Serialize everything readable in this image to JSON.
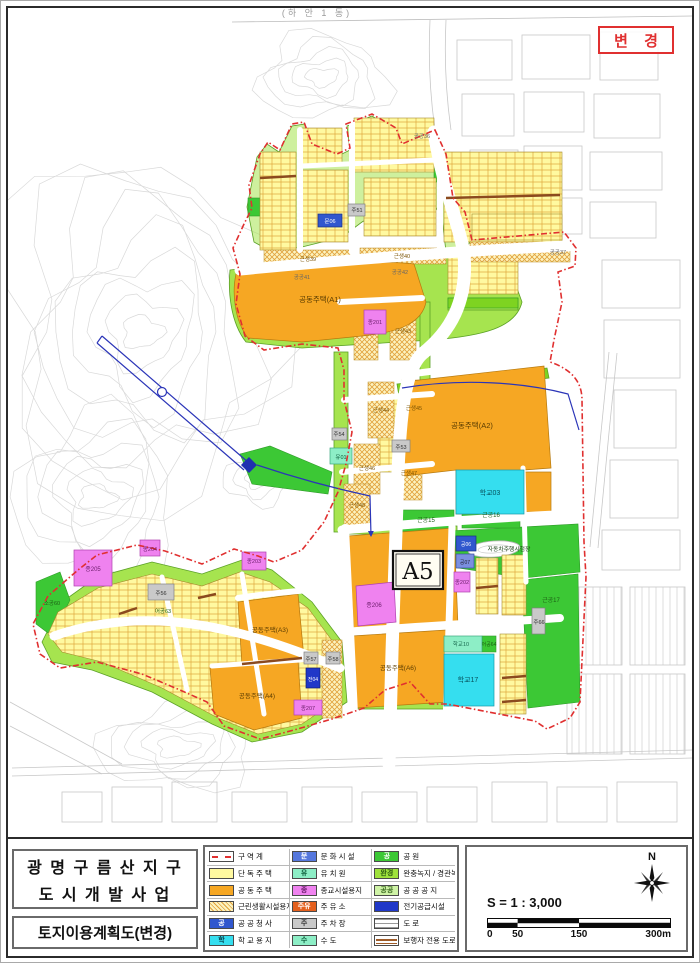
{
  "stamp": {
    "label": "변 경"
  },
  "title_block": {
    "line1": "광 명 구 름 산 지 구",
    "line2": "도 시 개 발 사 업",
    "subtitle": "토지이용계획도(변경)"
  },
  "legend": {
    "columns": [
      [
        {
          "label": "구 역 계",
          "kind": "boundary"
        },
        {
          "label": "단 독 주 택",
          "bg": "#FFF9A0"
        },
        {
          "label": "공 동 주 택",
          "bg": "#F6A723"
        },
        {
          "label": "근린생활시설용지",
          "kind": "hatch"
        },
        {
          "label": "공 공 청 사",
          "bg": "#3057CE",
          "txt": "공"
        },
        {
          "label": "학 교 용 지",
          "bg": "#35DEEF",
          "txt": "학",
          "txtc": "#063a46"
        }
      ],
      [
        {
          "label": "문 화 시 설",
          "bg": "#5577DD",
          "txt": "문"
        },
        {
          "label": "유 치 원",
          "bg": "#8DEEC6",
          "txt": "유",
          "txtc": "#0b5c3a"
        },
        {
          "label": "종교시설용지",
          "bg": "#EF82EF",
          "txt": "종",
          "txtc": "#6b1d6b"
        },
        {
          "label": "주 유 소",
          "bg": "#E4601E",
          "txt": "주유"
        },
        {
          "label": "주 차 장",
          "bg": "#C9C9C9",
          "txt": "주",
          "txtc": "#333333"
        },
        {
          "label": "수 도",
          "bg": "#8DEEC6",
          "txt": "수",
          "txtc": "#0b5c3a"
        }
      ],
      [
        {
          "label": "공 원",
          "bg": "#3CC835",
          "txt": "공"
        },
        {
          "label": "완충녹지 / 경관녹지",
          "bg": "#9FE23C",
          "txt": "완경",
          "txtc": "#2a5a10"
        },
        {
          "label": "공 공 공 지",
          "bg": "#CFF3A6",
          "txt": "공공",
          "txtc": "#3a6a20"
        },
        {
          "label": "전기공급시설",
          "bg": "#2038C8"
        },
        {
          "label": "도 로",
          "kind": "road"
        },
        {
          "label": "보행자 전용 도로",
          "kind": "ped"
        }
      ]
    ]
  },
  "scale": {
    "label": "S = 1 : 3,000",
    "north_label": "N",
    "breaks": [
      0,
      50,
      150,
      300
    ],
    "ticks": [
      "0",
      "50",
      "150",
      "300m"
    ],
    "row_colors": [
      [
        "#ffffff",
        "#0a0a0a",
        "#ffffff"
      ],
      [
        "#0a0a0a",
        "#ffffff",
        "#0a0a0a"
      ]
    ]
  },
  "map": {
    "a5_badge": "A5",
    "labels": [
      {
        "t": "(하 안 1 동)",
        "x": 315,
        "y": 14,
        "fs": 9,
        "c": "#9a9a9a",
        "ls": 3
      },
      {
        "t": "공동주택(A1)",
        "x": 318,
        "y": 300,
        "fs": 7.5,
        "c": "#5a3c00"
      },
      {
        "t": "공동주택(A2)",
        "x": 470,
        "y": 426,
        "fs": 7.5,
        "c": "#5a3c00"
      },
      {
        "t": "공동주택(A3)",
        "x": 268,
        "y": 630,
        "fs": 6.5,
        "c": "#5a3c00"
      },
      {
        "t": "공동주택(A4)",
        "x": 255,
        "y": 696,
        "fs": 6.5,
        "c": "#5a3c00"
      },
      {
        "t": "공동주택(A6)",
        "x": 396,
        "y": 668,
        "fs": 6.5,
        "c": "#5a3c00"
      },
      {
        "t": "학교03",
        "x": 488,
        "y": 493,
        "fs": 7,
        "c": "#06515c"
      },
      {
        "t": "학교10",
        "x": 459,
        "y": 644,
        "fs": 5.5,
        "c": "#1a6a50"
      },
      {
        "t": "어공64",
        "x": 487,
        "y": 644,
        "fs": 5,
        "c": "#1c5e14"
      },
      {
        "t": "학교17",
        "x": 466,
        "y": 680,
        "fs": 7,
        "c": "#06515c"
      },
      {
        "t": "어공63",
        "x": 161,
        "y": 611,
        "fs": 5.5,
        "c": "#1c5e14"
      },
      {
        "t": "근공15",
        "x": 424,
        "y": 520,
        "fs": 6,
        "c": "#1c5e14"
      },
      {
        "t": "근공16",
        "x": 489,
        "y": 515,
        "fs": 6,
        "c": "#1c5e14"
      },
      {
        "t": "근공17",
        "x": 549,
        "y": 600,
        "fs": 6,
        "c": "#1c5e14"
      },
      {
        "t": "소공60",
        "x": 50,
        "y": 603,
        "fs": 5.5,
        "c": "#1c5e14"
      },
      {
        "t": "자동차주행시험장",
        "x": 507,
        "y": 549,
        "fs": 5.8,
        "c": "#143d10"
      },
      {
        "t": "종201",
        "x": 373,
        "y": 322,
        "fs": 5.5,
        "c": "#6b1d6b"
      },
      {
        "t": "종202",
        "x": 460,
        "y": 582,
        "fs": 5.5,
        "c": "#6b1d6b"
      },
      {
        "t": "종203",
        "x": 252,
        "y": 561,
        "fs": 5.5,
        "c": "#6b1d6b"
      },
      {
        "t": "종204",
        "x": 148,
        "y": 549,
        "fs": 5.5,
        "c": "#6b1d6b"
      },
      {
        "t": "종205",
        "x": 91,
        "y": 569,
        "fs": 6,
        "c": "#6b1d6b"
      },
      {
        "t": "종206",
        "x": 372,
        "y": 605,
        "fs": 6,
        "c": "#6b1d6b"
      },
      {
        "t": "종207",
        "x": 306,
        "y": 708,
        "fs": 5.5,
        "c": "#6b1d6b"
      },
      {
        "t": "주51",
        "x": 355,
        "y": 210,
        "fs": 5.5,
        "c": "#333333"
      },
      {
        "t": "주53",
        "x": 399,
        "y": 447,
        "fs": 5.5,
        "c": "#333333"
      },
      {
        "t": "주54",
        "x": 337,
        "y": 434,
        "fs": 5.5,
        "c": "#333333"
      },
      {
        "t": "주56",
        "x": 159,
        "y": 593,
        "fs": 5.5,
        "c": "#333333"
      },
      {
        "t": "주57",
        "x": 309,
        "y": 659,
        "fs": 5.5,
        "c": "#333333"
      },
      {
        "t": "주58",
        "x": 331,
        "y": 659,
        "fs": 5.5,
        "c": "#333333"
      },
      {
        "t": "주66",
        "x": 537,
        "y": 622,
        "fs": 5.5,
        "c": "#333333"
      },
      {
        "t": "유01",
        "x": 339,
        "y": 457,
        "fs": 5.5,
        "c": "#0b5c3a"
      },
      {
        "t": "문06",
        "x": 328,
        "y": 221,
        "fs": 5.5,
        "c": "#ffffff"
      },
      {
        "t": "공06",
        "x": 464,
        "y": 544,
        "fs": 5,
        "c": "#ffffff"
      },
      {
        "t": "공07",
        "x": 463,
        "y": 562,
        "fs": 5,
        "c": "#222233"
      },
      {
        "t": "전04",
        "x": 311,
        "y": 679,
        "fs": 5,
        "c": "#ffffff"
      },
      {
        "t": "근생39",
        "x": 306,
        "y": 259,
        "fs": 5.5,
        "c": "#7a5200"
      },
      {
        "t": "근생40",
        "x": 400,
        "y": 256,
        "fs": 5.5,
        "c": "#7a5200"
      },
      {
        "t": "공공37",
        "x": 556,
        "y": 252,
        "fs": 5.5,
        "c": "#666666"
      },
      {
        "t": "공공36",
        "x": 420,
        "y": 136,
        "fs": 5.5,
        "c": "#666666"
      },
      {
        "t": "공공41",
        "x": 300,
        "y": 277,
        "fs": 5.5,
        "c": "#666666"
      },
      {
        "t": "공공42",
        "x": 398,
        "y": 272,
        "fs": 5.5,
        "c": "#666666"
      },
      {
        "t": "근생43",
        "x": 401,
        "y": 331,
        "fs": 5.5,
        "c": "#7a5200"
      },
      {
        "t": "근생44",
        "x": 379,
        "y": 410,
        "fs": 5.5,
        "c": "#7a5200"
      },
      {
        "t": "근생45",
        "x": 412,
        "y": 408,
        "fs": 5.5,
        "c": "#7a5200"
      },
      {
        "t": "근생46",
        "x": 365,
        "y": 468,
        "fs": 5.5,
        "c": "#7a5200"
      },
      {
        "t": "근생47",
        "x": 407,
        "y": 473,
        "fs": 5.5,
        "c": "#7a5200"
      },
      {
        "t": "근생48",
        "x": 355,
        "y": 505,
        "fs": 5.5,
        "c": "#7a5200"
      }
    ]
  }
}
